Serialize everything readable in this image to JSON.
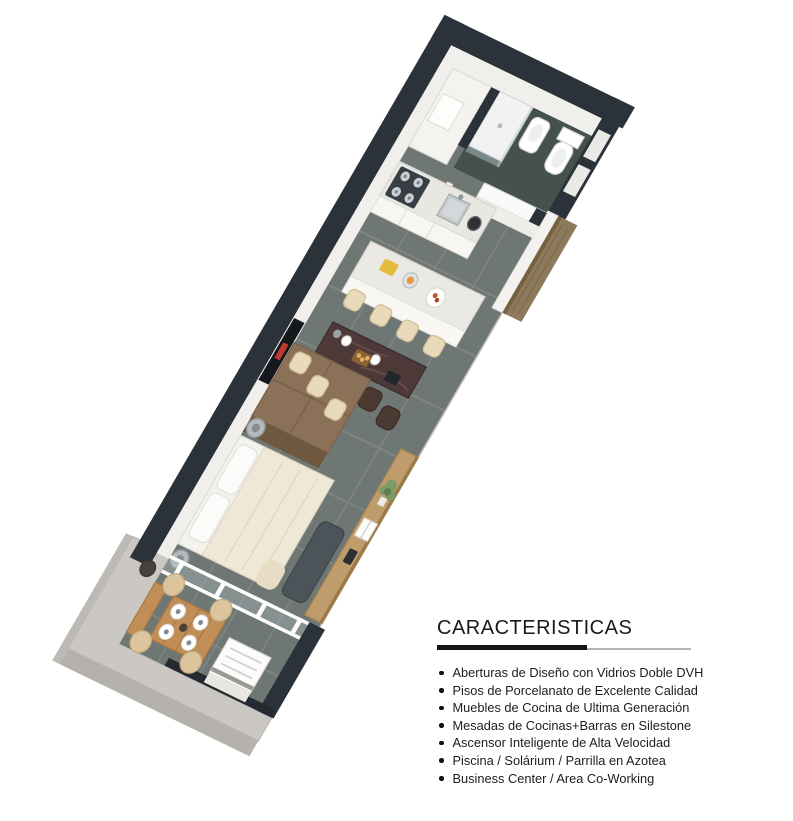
{
  "features": {
    "heading": "CARACTERISTICAS",
    "items": [
      "Aberturas de Diseño con Vidrios Doble DVH",
      "Pisos de Porcelanato de Excelente Calidad",
      "Muebles de Cocina de Ultima Generación",
      "Mesadas de Cocinas+Barras en Silestone",
      "Ascensor Inteligente de Alta Velocidad",
      "Piscina / Solárium / Parrilla en Azotea",
      "Business Center / Area Co-Working"
    ]
  },
  "palette": {
    "wall_dark": "#2b323a",
    "wall_white": "#f1efeb",
    "floor_tile": "#6f7774",
    "bathroom_floor": "#45514d",
    "wood_panel": "#8d795b",
    "wardrobe_wood": "#8b7158",
    "bar_marble": "#4e3939",
    "balcony_wood": "#c18e58",
    "concrete_slab": "#cbc8c3",
    "stool_cream": "#e9dabb",
    "sofa_gray": "#4d5459",
    "tv_accent_red": "#bf3a2f"
  }
}
